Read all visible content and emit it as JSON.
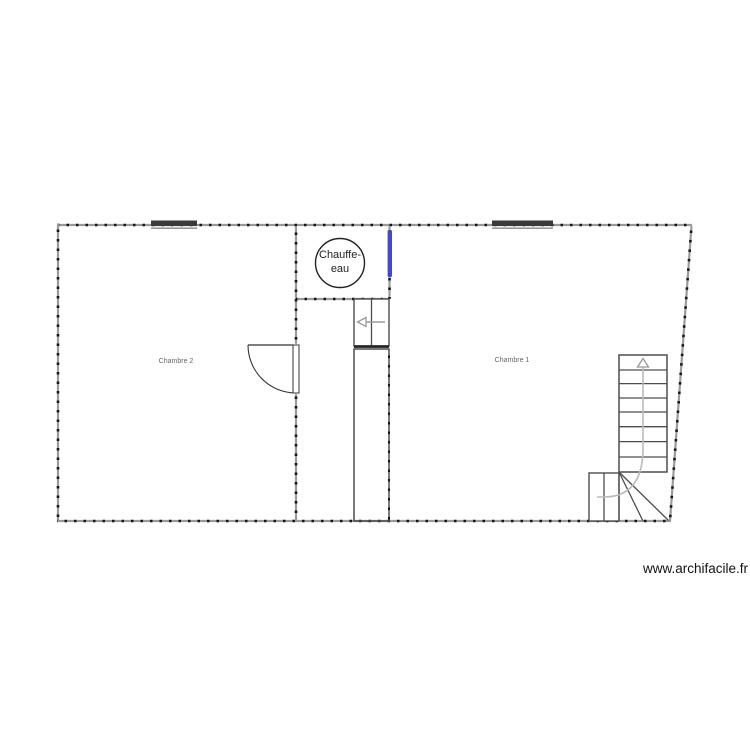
{
  "app": {
    "watermark_text": "www.archifacile.fr"
  },
  "floor_plan": {
    "rooms": [
      {
        "name": "Chambre 2"
      },
      {
        "name": "Chambre 1"
      }
    ],
    "water_heater": {
      "line1": "Chauffe-",
      "line2": "eau"
    },
    "icons": {
      "stair_up_arrow": "triangle-up-outline",
      "hatch_direction_arrow": "arrow-left-outline"
    },
    "colors": {
      "wall_base": "#9a9a9a",
      "wall_tick": "#151515",
      "selected_wall": "#4247d1",
      "window": "#3a3a3a",
      "stair_stroke": "#4d4d4d",
      "guide_line": "#bbbbbb",
      "room_label": "#666666",
      "text_dark": "#222222"
    }
  }
}
